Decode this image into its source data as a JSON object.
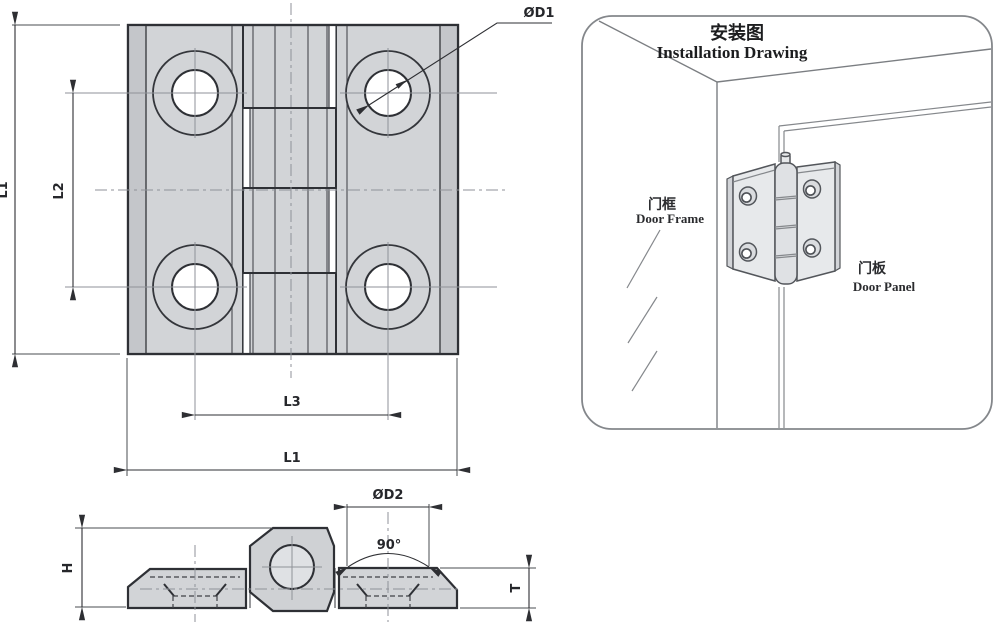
{
  "front_view": {
    "dim_height_label": "L1",
    "dim_hole_spacing_vertical_label": "L2",
    "dim_hole_spacing_horizontal_label": "L3",
    "dim_width_label": "L1",
    "dim_counterbore_diameter_label": "ØD1"
  },
  "side_view": {
    "dim_height_label": "H",
    "dim_thickness_label": "T",
    "dim_countersink_diameter_label": "ØD2",
    "countersink_angle_label": "90°"
  },
  "installation_drawing": {
    "title_zh": "安装图",
    "title_en": "Installation Drawing",
    "door_frame_label_zh": "门框",
    "door_frame_label_en": "Door Frame",
    "door_panel_label_zh": "门板",
    "door_panel_label_en": "Door Panel"
  },
  "colors": {
    "background": "#ffffff",
    "object_line": "#2e3035",
    "plate_fill": "#d2d4d7",
    "plate_edge_fill": "#c4c6ca",
    "centerline": "#8f9298",
    "installation_line": "#7b7e82"
  }
}
